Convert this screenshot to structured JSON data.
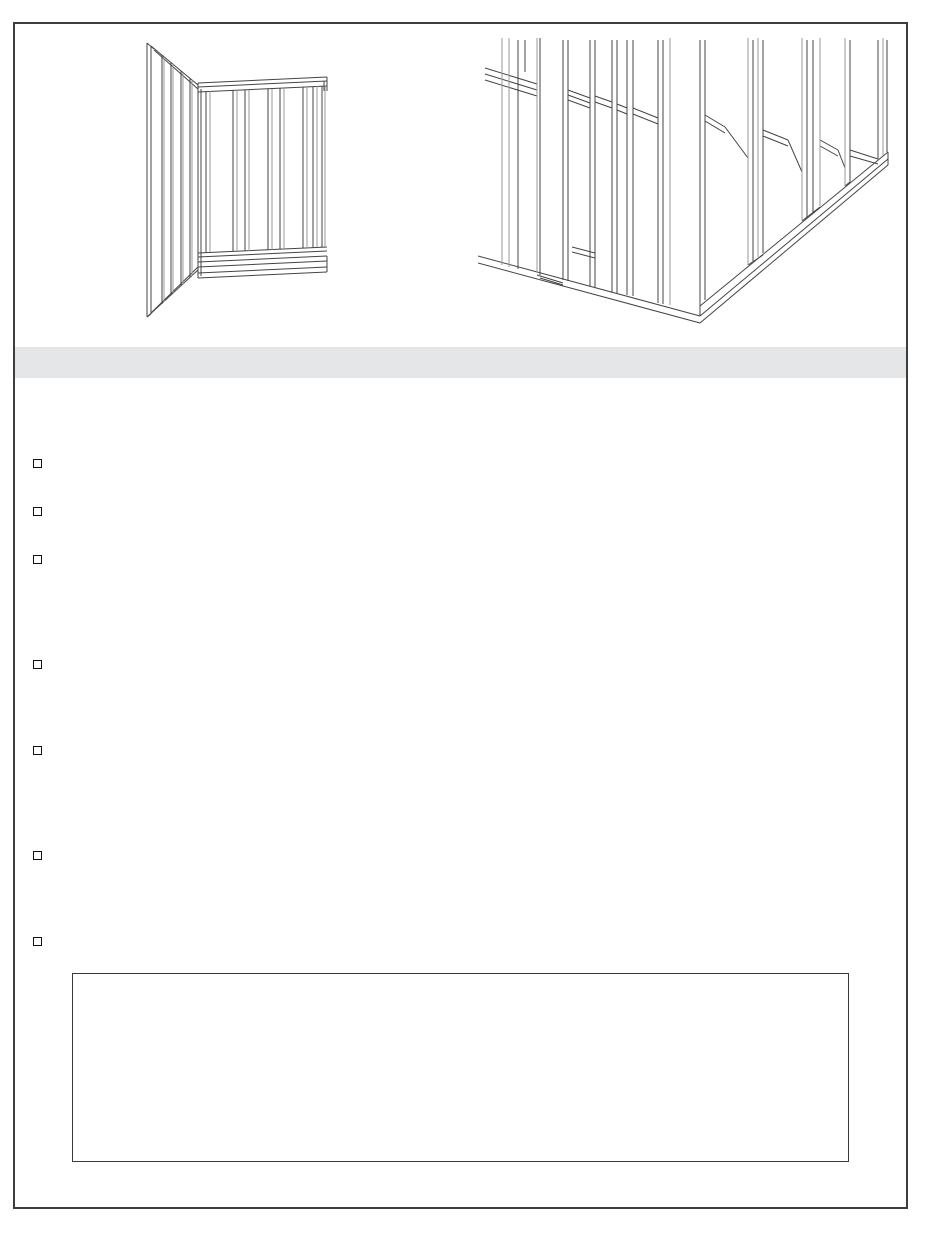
{
  "page": {
    "type": "instruction-sheet-page",
    "background_color": "#ffffff",
    "border_color": "#3d3d3d",
    "line_art_color": "#444444",
    "line_art_secondary_color": "#9a9a9a"
  },
  "figures": [
    {
      "name": "wall-framing-corner-overview"
    },
    {
      "name": "wall-framing-corner-closeup"
    }
  ],
  "section_band": {
    "label": "",
    "background_color": "#e5e6e8"
  },
  "checklist": {
    "marker_style": "unchecked-square",
    "items": [
      {
        "label": ""
      },
      {
        "label": ""
      },
      {
        "label": ""
      },
      {
        "label": ""
      },
      {
        "label": ""
      },
      {
        "label": ""
      },
      {
        "label": ""
      }
    ]
  },
  "note_box": {
    "content": ""
  }
}
